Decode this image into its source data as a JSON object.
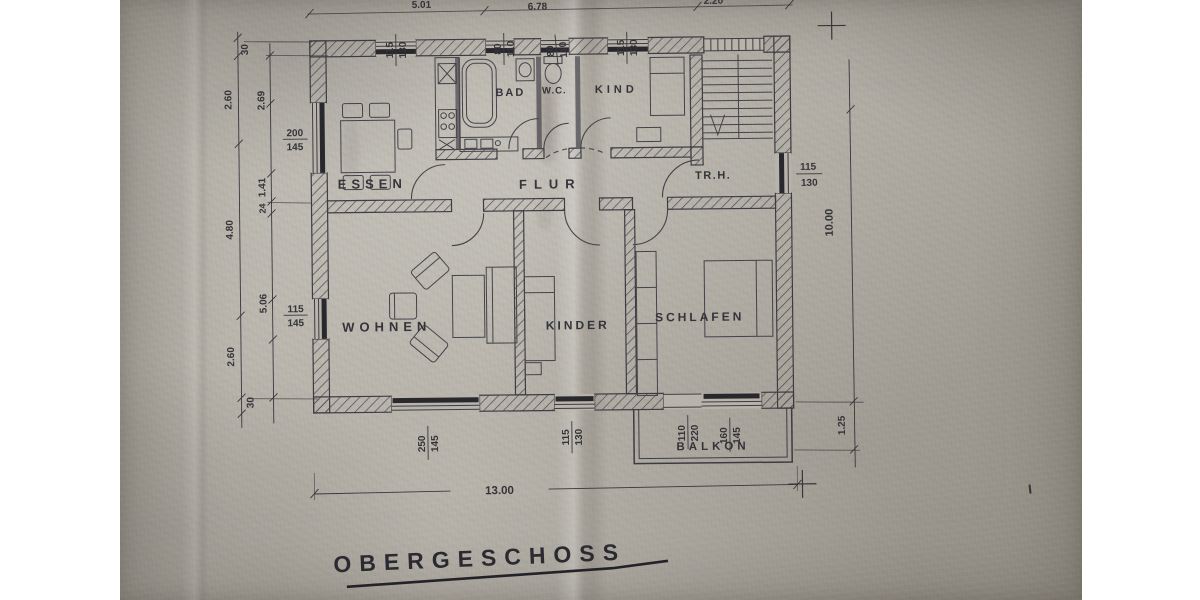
{
  "title": "OBERGESCHOSS",
  "rooms": {
    "essen": "ESSEN",
    "bad": "BAD",
    "wc": "W.C.",
    "kind": "KIND",
    "flur": "FLUR",
    "trh": "TR.H.",
    "wohnen": "WOHNEN",
    "kinder": "KINDER",
    "schlafen": "SCHLAFEN",
    "balkon": "BALKON"
  },
  "dims": {
    "left_outer": [
      "30",
      "2.60",
      "4.80",
      "2.60",
      "30"
    ],
    "left_inner": [
      "2.69",
      "1.41",
      "24",
      "5.06"
    ],
    "top_cut": [
      "5.01",
      "6.78",
      "2.20"
    ],
    "right_total": "10.00",
    "balcony_depth": "1.25",
    "bottom_total": "13.00"
  },
  "windows": {
    "left_essen": [
      "200",
      "145"
    ],
    "left_wohnen": [
      "115",
      "145"
    ],
    "top_essen": [
      "115",
      "130"
    ],
    "top_bad": [
      "80",
      "110"
    ],
    "top_wc": [
      "80",
      "110"
    ],
    "top_kind": [
      "115",
      "130"
    ],
    "right_trh": [
      "115",
      "130"
    ],
    "bottom_wohnen": [
      "250",
      "145"
    ],
    "bottom_kinder": [
      "115",
      "130"
    ],
    "balcony_door": [
      "110",
      "220"
    ],
    "balcony_window": [
      "160",
      "145"
    ]
  },
  "colors": {
    "paper": "#b5b1a8",
    "ink": "#2b2a30"
  }
}
